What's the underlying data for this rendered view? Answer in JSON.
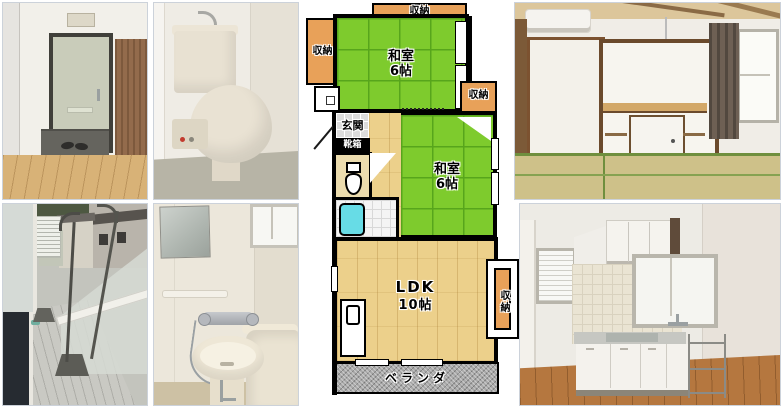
{
  "floorplan": {
    "labels": {
      "storage_top": "収納",
      "storage_left": "収納",
      "storage_right": "収納",
      "storage_ldk": "収納",
      "washitsu1_name": "和室",
      "washitsu1_size": "6帖",
      "washitsu2_name": "和室",
      "washitsu2_size": "6帖",
      "genkan": "玄関",
      "shoe_box": "靴箱",
      "ldk_name": "LDK",
      "ldk_size": "10帖",
      "veranda": "ベランダ"
    },
    "colors": {
      "tatami_green": "#7ecb2d",
      "storage_orange": "#e8a159",
      "flooring_tan": "#ecd08b",
      "veranda_gray": "#a9a9a9",
      "bathtub_cyan": "#67dce6",
      "genkan_tile_gray": "#dcdcdc",
      "wall_black": "#000000"
    }
  },
  "photos": [
    {
      "id": "entrance"
    },
    {
      "id": "toilet"
    },
    {
      "id": "tatami-room"
    },
    {
      "id": "balcony"
    },
    {
      "id": "bathroom"
    },
    {
      "id": "kitchen-ldk"
    }
  ]
}
